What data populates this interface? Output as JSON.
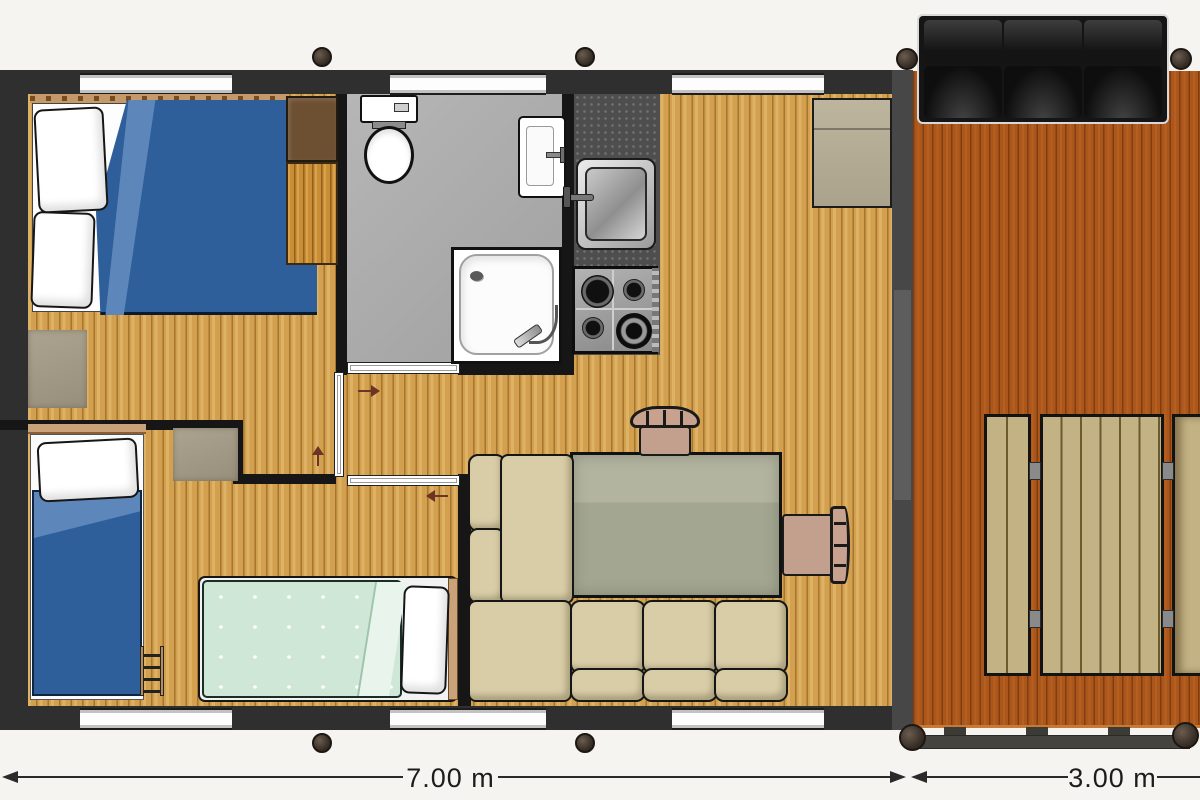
{
  "plan": {
    "type": "floorplan",
    "dimension_labels": {
      "building_width": "7.00 m",
      "terrace_width": "3.00 m"
    },
    "rooms": [
      "bedroom-double",
      "bedroom-twin",
      "bathroom",
      "kitchen",
      "living-dining",
      "terrace"
    ],
    "furniture": [
      "double-bed",
      "single-bed",
      "single-bed-mint",
      "wardrobe",
      "toilet",
      "bathroom-sink",
      "shower",
      "kitchen-sink",
      "gas-hob",
      "dining-table",
      "chair",
      "corner-sofa",
      "cabinet",
      "terrace-sofa",
      "picnic-table",
      "picnic-bench",
      "terrace-railing",
      "ladder"
    ],
    "colors": {
      "background": "#f5f4f1",
      "exterior_wall": "#2f2f2f",
      "interior_wall": "#161616",
      "oak_floor": "#d2a04e",
      "terrace_deck": "#ab561b",
      "bathroom_floor": "#adadad",
      "kitchen_counter": "#4e4e4e",
      "bed_blue": "#2e5f9b",
      "mint_blanket": "#cfe7d7",
      "sofa_cushion": "#d9cda8",
      "dining_table": "#a8ab97",
      "chair_wood": "#c9a28f",
      "terrace_sofa": "#151515"
    }
  }
}
